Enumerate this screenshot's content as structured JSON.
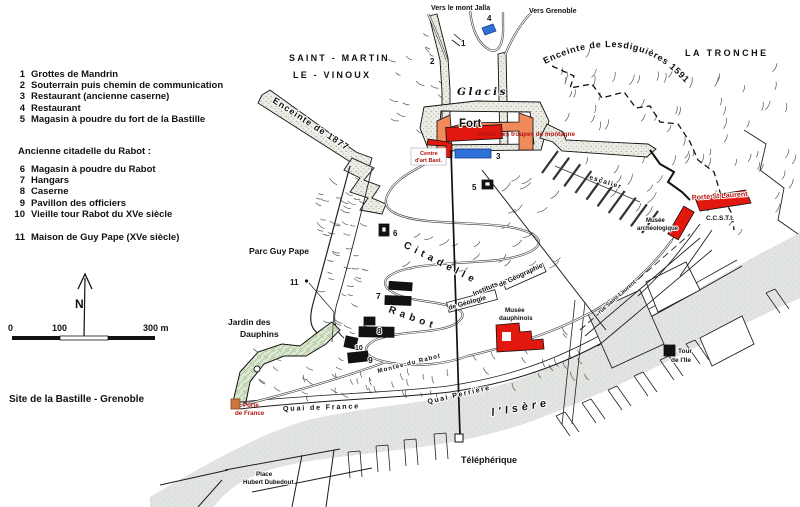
{
  "title": "Site de la Bastille - Grenoble",
  "legend": {
    "section_header": "Ancienne citadelle du Rabot :",
    "items": [
      {
        "num": "1",
        "label": "Grottes de Mandrin"
      },
      {
        "num": "2",
        "label": "Souterrain puis chemin de communication"
      },
      {
        "num": "3",
        "label": "Restaurant (ancienne caserne)"
      },
      {
        "num": "4",
        "label": "Restaurant"
      },
      {
        "num": "5",
        "label": "Magasin à poudre du fort de la Bastille"
      },
      {
        "num": "6",
        "label": "Magasin à poudre du Rabot"
      },
      {
        "num": "7",
        "label": "Hangars"
      },
      {
        "num": "8",
        "label": "Caserne"
      },
      {
        "num": "9",
        "label": "Pavillon des officiers"
      },
      {
        "num": "10",
        "label": "Vieille tour Rabot du XVe siècle"
      },
      {
        "num": "11",
        "label": "Maison de Guy Pape (XVe siècle)"
      }
    ]
  },
  "scale": {
    "t0": "0",
    "t100": "100",
    "t300": "300 m",
    "north": "N"
  },
  "labels": {
    "vers_mont_jalla": "Vers le mont Jalla",
    "vers_grenoble": "Vers Grenoble",
    "saint_martin": "SAINT - MARTIN",
    "le_vinoux": "LE - VINOUX",
    "la_tronche": "LA TRONCHE",
    "enceinte_lesdiguieres": "Enceinte de Lesdiguières 1591",
    "enceinte_1877": "Enceinte de 1877",
    "glacis": "Glacis",
    "fort": "Fort",
    "musee_troupes": "Musée des troupes de montagne",
    "centre_art_l1": "Centre",
    "centre_art_l2": "d'art Bast.",
    "escalier": "escalier",
    "porte_st_laurent": "Porte St Laurent",
    "ccsti": "C.C.S.T.I.",
    "musee_archeo_l1": "Musée",
    "musee_archeo_l2": "archéologique",
    "citadelle": "Citadelle",
    "rabot": "Rabot",
    "parc_guy_pape": "Parc Guy Pape",
    "jardin_l1": "Jardin des",
    "jardin_l2": "Dauphins",
    "musee_dauphinois_l1": "Musée",
    "musee_dauphinois_l2": "dauphinois",
    "instituts": "Instituts",
    "de_geographie": "de Géographie",
    "de_geologie": "de Géologie",
    "rue_saint_laurent": "rue Saint-Laurent",
    "montee_du_rabot": "Montée du Rabot",
    "porte_france_l1": "Porte",
    "porte_france_l2": "de France",
    "quai_de_france": "Quai de France",
    "quai_perriere": "Quai Perrière",
    "isere": "l'Isère",
    "telepherique": "Téléphérique",
    "tour_ile_l1": "Tour",
    "tour_ile_l2": "de l'Ile",
    "place_l1": "Place",
    "place_l2": "Hubert Dubedout"
  },
  "markers": {
    "n1": "1",
    "n2": "2",
    "n3": "3",
    "n4": "4",
    "n5": "5",
    "n6": "6",
    "n7": "7",
    "n8": "8",
    "n9": "9",
    "n10": "10",
    "n11": "11"
  },
  "colors": {
    "building_red": "#e2180f",
    "fort_orange": "#f08a5a",
    "marker_blue": "#2e6fd8",
    "porte_orange": "#c8753e",
    "garden_green": "#dbe7d2",
    "label_red": "#b01510"
  }
}
